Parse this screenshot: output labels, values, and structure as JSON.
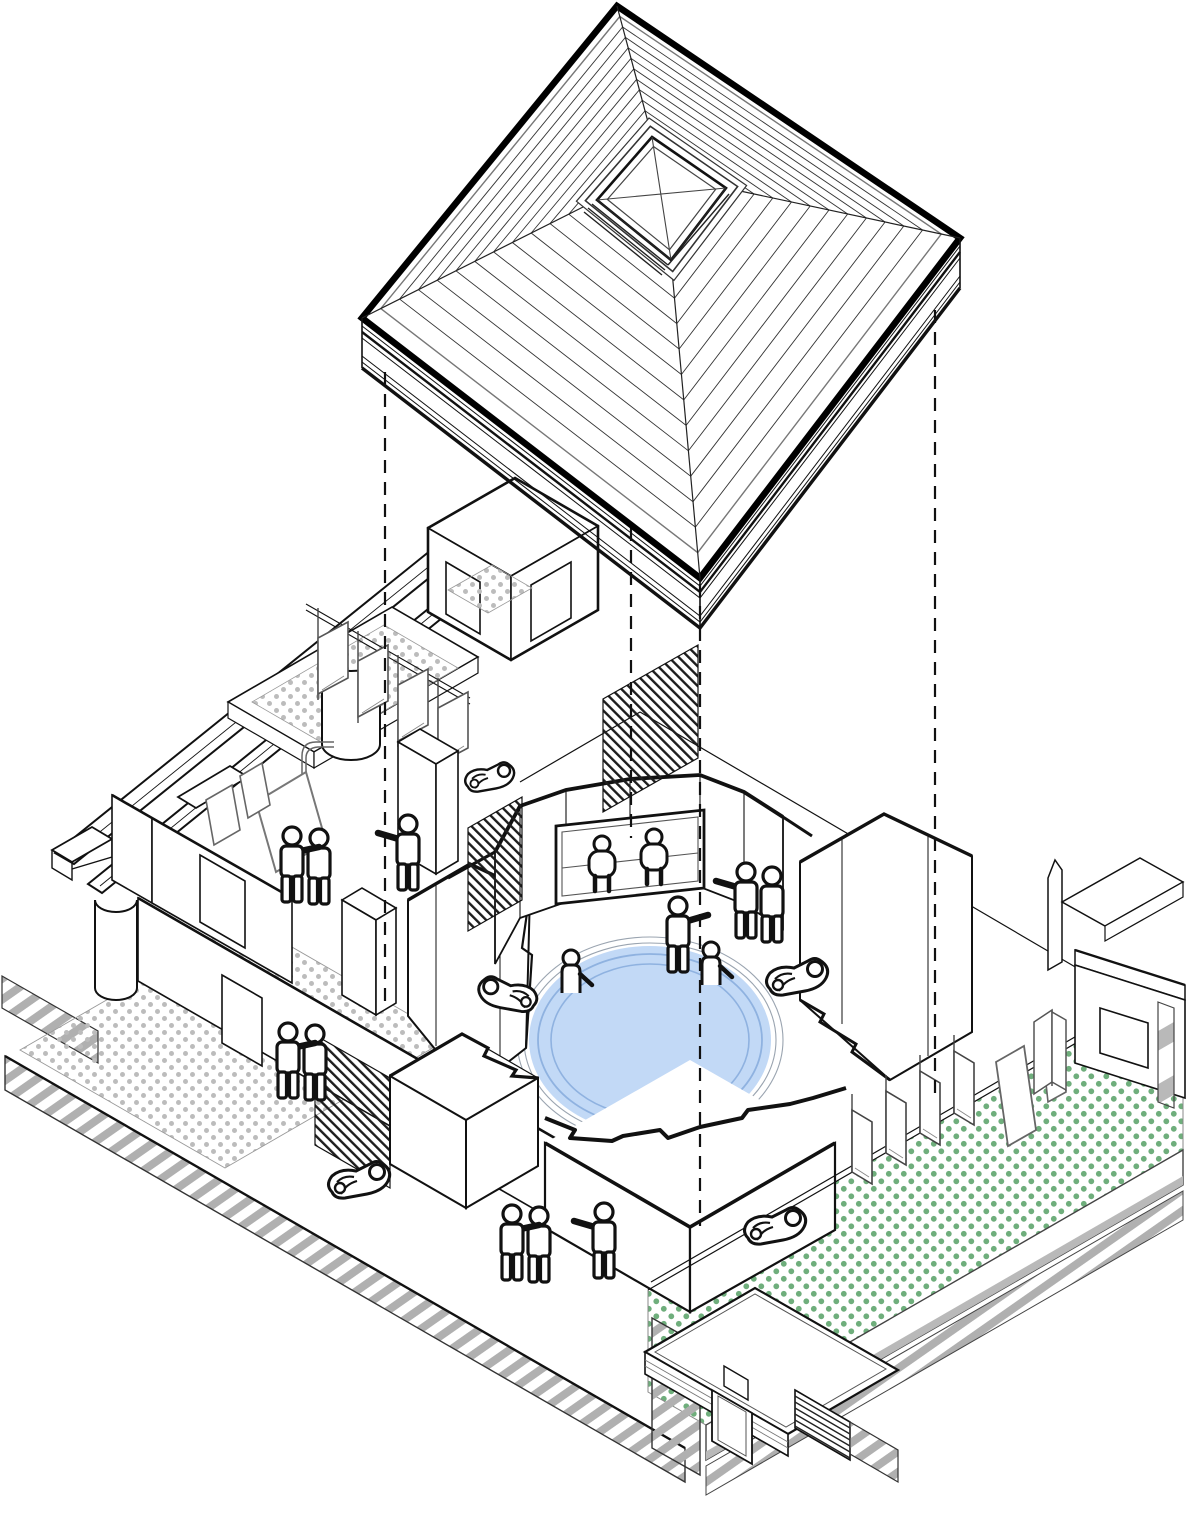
{
  "meta": {
    "description": "Axonometric exploded diagram of a bath pavilion: hipped pyramid roof with square skylight lifted above an isometric plan with a central circular pool, courtyard screens, terraces and human figures",
    "background": "#ffffff"
  },
  "colors": {
    "line": "#111111",
    "frame_gray": "#666666",
    "light_gray": "#999999",
    "pool_fill": "#C2D9F6",
    "pool_ring": "#8FB2E0",
    "pool_halo": "#9aa4b0",
    "green_dot": "#6FAE7C",
    "gray_dot": "#BCBCBC",
    "hatch_gray": "#B0B0B0",
    "band_gray": "#B9B9B9",
    "screen_black": "#1D1D1D"
  },
  "roof": {
    "type": "hipped pyramid, striped shingle courses",
    "stripe_courses": 12,
    "skylight": "raised square rooflight with X glazing bars",
    "fascia": "layered eave band on the two lower edges"
  },
  "projection_lines": {
    "style": "dashed",
    "count": 4
  },
  "pool": {
    "shape": "circular pool (ellipse in axonometry)",
    "deck_steps": 2,
    "water_rings": 2
  },
  "figures": {
    "standing_pairs": 4,
    "standing_singles_pointing": 3,
    "seated_at_window": 2,
    "bathing_in_pool": 2,
    "lounging_on_beanbags": 5
  },
  "patterns": {
    "terrace_right": "green dot grid",
    "terrace_left": "gray dot grid",
    "section_cut": "diagonal gray hatch",
    "parapet": "intermittent gray bands",
    "timber_screens": "dense diagonal black hatch"
  }
}
